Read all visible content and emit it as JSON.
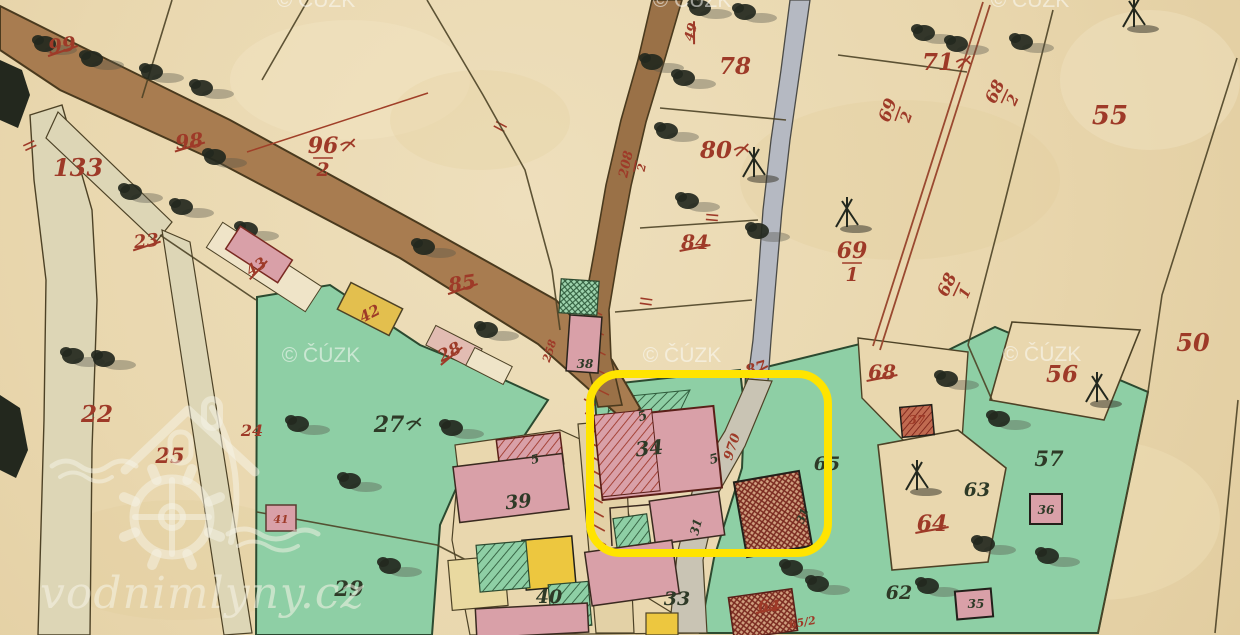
{
  "map": {
    "type": "historical-cadastral-map",
    "copyright_watermark": "© ČÚZK",
    "brand_watermark": "vodnimlyny.cz",
    "highlight_box": {
      "x": 590,
      "y": 374,
      "width": 238,
      "height": 179,
      "corner_radius": 30,
      "color": "#ffe400",
      "border_px": 8
    },
    "palette": {
      "paper": "#e9d7ae",
      "meadow_green": "#8ecfa5",
      "road_brown": "#a87c50",
      "stream_brown": "#9a7147",
      "stream_gray": "#b5b9c2",
      "building_pink": "#d9a0a8",
      "building_yellow": "#e3bf4e",
      "label_red": "#9e3a28",
      "label_dark": "#2e3a27",
      "boundary": "#4d4226",
      "watermark_white": "#f6f4e8"
    },
    "parcel_labels": [
      {
        "t": "99",
        "x": 63,
        "y": 52,
        "s": 20,
        "c": "red",
        "r": -8,
        "k": true
      },
      {
        "t": "133",
        "x": 78,
        "y": 176,
        "s": 24,
        "c": "red"
      },
      {
        "t": "98",
        "x": 190,
        "y": 148,
        "s": 20,
        "c": "red",
        "r": -6,
        "k": true
      },
      {
        "t": "96",
        "x": 323,
        "y": 153,
        "s": 22,
        "c": "red",
        "d": "2",
        "f": true
      },
      {
        "t": "23",
        "x": 147,
        "y": 247,
        "s": 18,
        "c": "red",
        "r": -6,
        "k": true
      },
      {
        "t": "43",
        "x": 259,
        "y": 271,
        "s": 15,
        "c": "red",
        "r": -33,
        "k": true
      },
      {
        "t": "28",
        "x": 452,
        "y": 357,
        "s": 17,
        "c": "red",
        "r": -27,
        "k": true
      },
      {
        "t": "85",
        "x": 463,
        "y": 290,
        "s": 20,
        "c": "red",
        "r": -8,
        "k": true
      },
      {
        "t": "42",
        "x": 372,
        "y": 318,
        "s": 15,
        "c": "red",
        "r": -27
      },
      {
        "t": "78",
        "x": 735,
        "y": 74,
        "s": 23,
        "c": "red"
      },
      {
        "t": "80",
        "x": 716,
        "y": 158,
        "s": 23,
        "c": "red",
        "f": true
      },
      {
        "t": "84",
        "x": 695,
        "y": 249,
        "s": 20,
        "c": "red",
        "k": true
      },
      {
        "t": "208",
        "x": 630,
        "y": 165,
        "s": 13,
        "c": "red",
        "r": -78,
        "d": "2"
      },
      {
        "t": "87",
        "x": 757,
        "y": 373,
        "s": 15,
        "c": "red",
        "r": -15,
        "k": true
      },
      {
        "t": "970",
        "x": 736,
        "y": 448,
        "s": 13,
        "c": "red",
        "r": -72
      },
      {
        "t": "71",
        "x": 938,
        "y": 70,
        "s": 23,
        "c": "red",
        "f": true
      },
      {
        "t": "55",
        "x": 1110,
        "y": 124,
        "s": 26,
        "c": "red"
      },
      {
        "t": "68",
        "x": 1000,
        "y": 94,
        "s": 17,
        "c": "red",
        "r": -65,
        "d": "2"
      },
      {
        "t": "69",
        "x": 893,
        "y": 112,
        "s": 17,
        "c": "red",
        "r": -70,
        "d": "2"
      },
      {
        "t": "69",
        "x": 852,
        "y": 258,
        "s": 22,
        "c": "red",
        "d": "1"
      },
      {
        "t": "68",
        "x": 952,
        "y": 287,
        "s": 17,
        "c": "red",
        "r": -65,
        "d": "1"
      },
      {
        "t": "50",
        "x": 1193,
        "y": 351,
        "s": 24,
        "c": "red"
      },
      {
        "t": "56",
        "x": 1062,
        "y": 382,
        "s": 23,
        "c": "red"
      },
      {
        "t": "68",
        "x": 882,
        "y": 379,
        "s": 20,
        "c": "red",
        "k": true
      },
      {
        "t": "37",
        "x": 917,
        "y": 424,
        "s": 12,
        "c": "red"
      },
      {
        "t": "64",
        "x": 932,
        "y": 531,
        "s": 22,
        "c": "red",
        "k": true
      },
      {
        "t": "22",
        "x": 97,
        "y": 422,
        "s": 23,
        "c": "red"
      },
      {
        "t": "24",
        "x": 252,
        "y": 436,
        "s": 16,
        "c": "red"
      },
      {
        "t": "25",
        "x": 170,
        "y": 463,
        "s": 21,
        "c": "red"
      },
      {
        "t": "64",
        "x": 769,
        "y": 611,
        "s": 16,
        "c": "red",
        "k": true
      },
      {
        "t": "65/2",
        "x": 803,
        "y": 626,
        "s": 11,
        "c": "red",
        "r": -10
      },
      {
        "t": "41",
        "x": 281,
        "y": 523,
        "s": 11,
        "c": "red"
      },
      {
        "t": "258",
        "x": 553,
        "y": 352,
        "s": 11,
        "c": "red",
        "r": -72
      },
      {
        "t": "49",
        "x": 695,
        "y": 33,
        "s": 13,
        "c": "red",
        "r": -75,
        "k": true
      },
      {
        "t": "27",
        "x": 389,
        "y": 432,
        "s": 22,
        "c": "dark",
        "f": true
      },
      {
        "t": "29",
        "x": 349,
        "y": 596,
        "s": 21,
        "c": "dark"
      },
      {
        "t": "39",
        "x": 519,
        "y": 508,
        "s": 19,
        "c": "dark",
        "r": -6
      },
      {
        "t": "40",
        "x": 549,
        "y": 603,
        "s": 19,
        "c": "dark"
      },
      {
        "t": "33",
        "x": 677,
        "y": 605,
        "s": 19,
        "c": "dark"
      },
      {
        "t": "34",
        "x": 650,
        "y": 455,
        "s": 20,
        "c": "dark",
        "r": -6
      },
      {
        "t": "31",
        "x": 700,
        "y": 528,
        "s": 12,
        "c": "dark",
        "r": -75
      },
      {
        "t": "31",
        "x": 806,
        "y": 517,
        "s": 11,
        "c": "dark",
        "r": -70
      },
      {
        "t": "57",
        "x": 1049,
        "y": 466,
        "s": 21,
        "c": "dark"
      },
      {
        "t": "63",
        "x": 977,
        "y": 496,
        "s": 19,
        "c": "dark"
      },
      {
        "t": "65",
        "x": 827,
        "y": 470,
        "s": 19,
        "c": "dark"
      },
      {
        "t": "62",
        "x": 899,
        "y": 599,
        "s": 19,
        "c": "dark"
      },
      {
        "t": "36",
        "x": 1046,
        "y": 514,
        "s": 12,
        "c": "dark"
      },
      {
        "t": "35",
        "x": 976,
        "y": 608,
        "s": 12,
        "c": "dark"
      },
      {
        "t": "38",
        "x": 585,
        "y": 368,
        "s": 12,
        "c": "dark"
      },
      {
        "t": "5",
        "x": 644,
        "y": 420,
        "s": 13,
        "c": "dark",
        "r": -20
      },
      {
        "t": "5",
        "x": 715,
        "y": 463,
        "s": 13,
        "c": "dark",
        "r": -15
      },
      {
        "t": "5",
        "x": 536,
        "y": 463,
        "s": 12,
        "c": "dark",
        "r": -15
      }
    ]
  }
}
